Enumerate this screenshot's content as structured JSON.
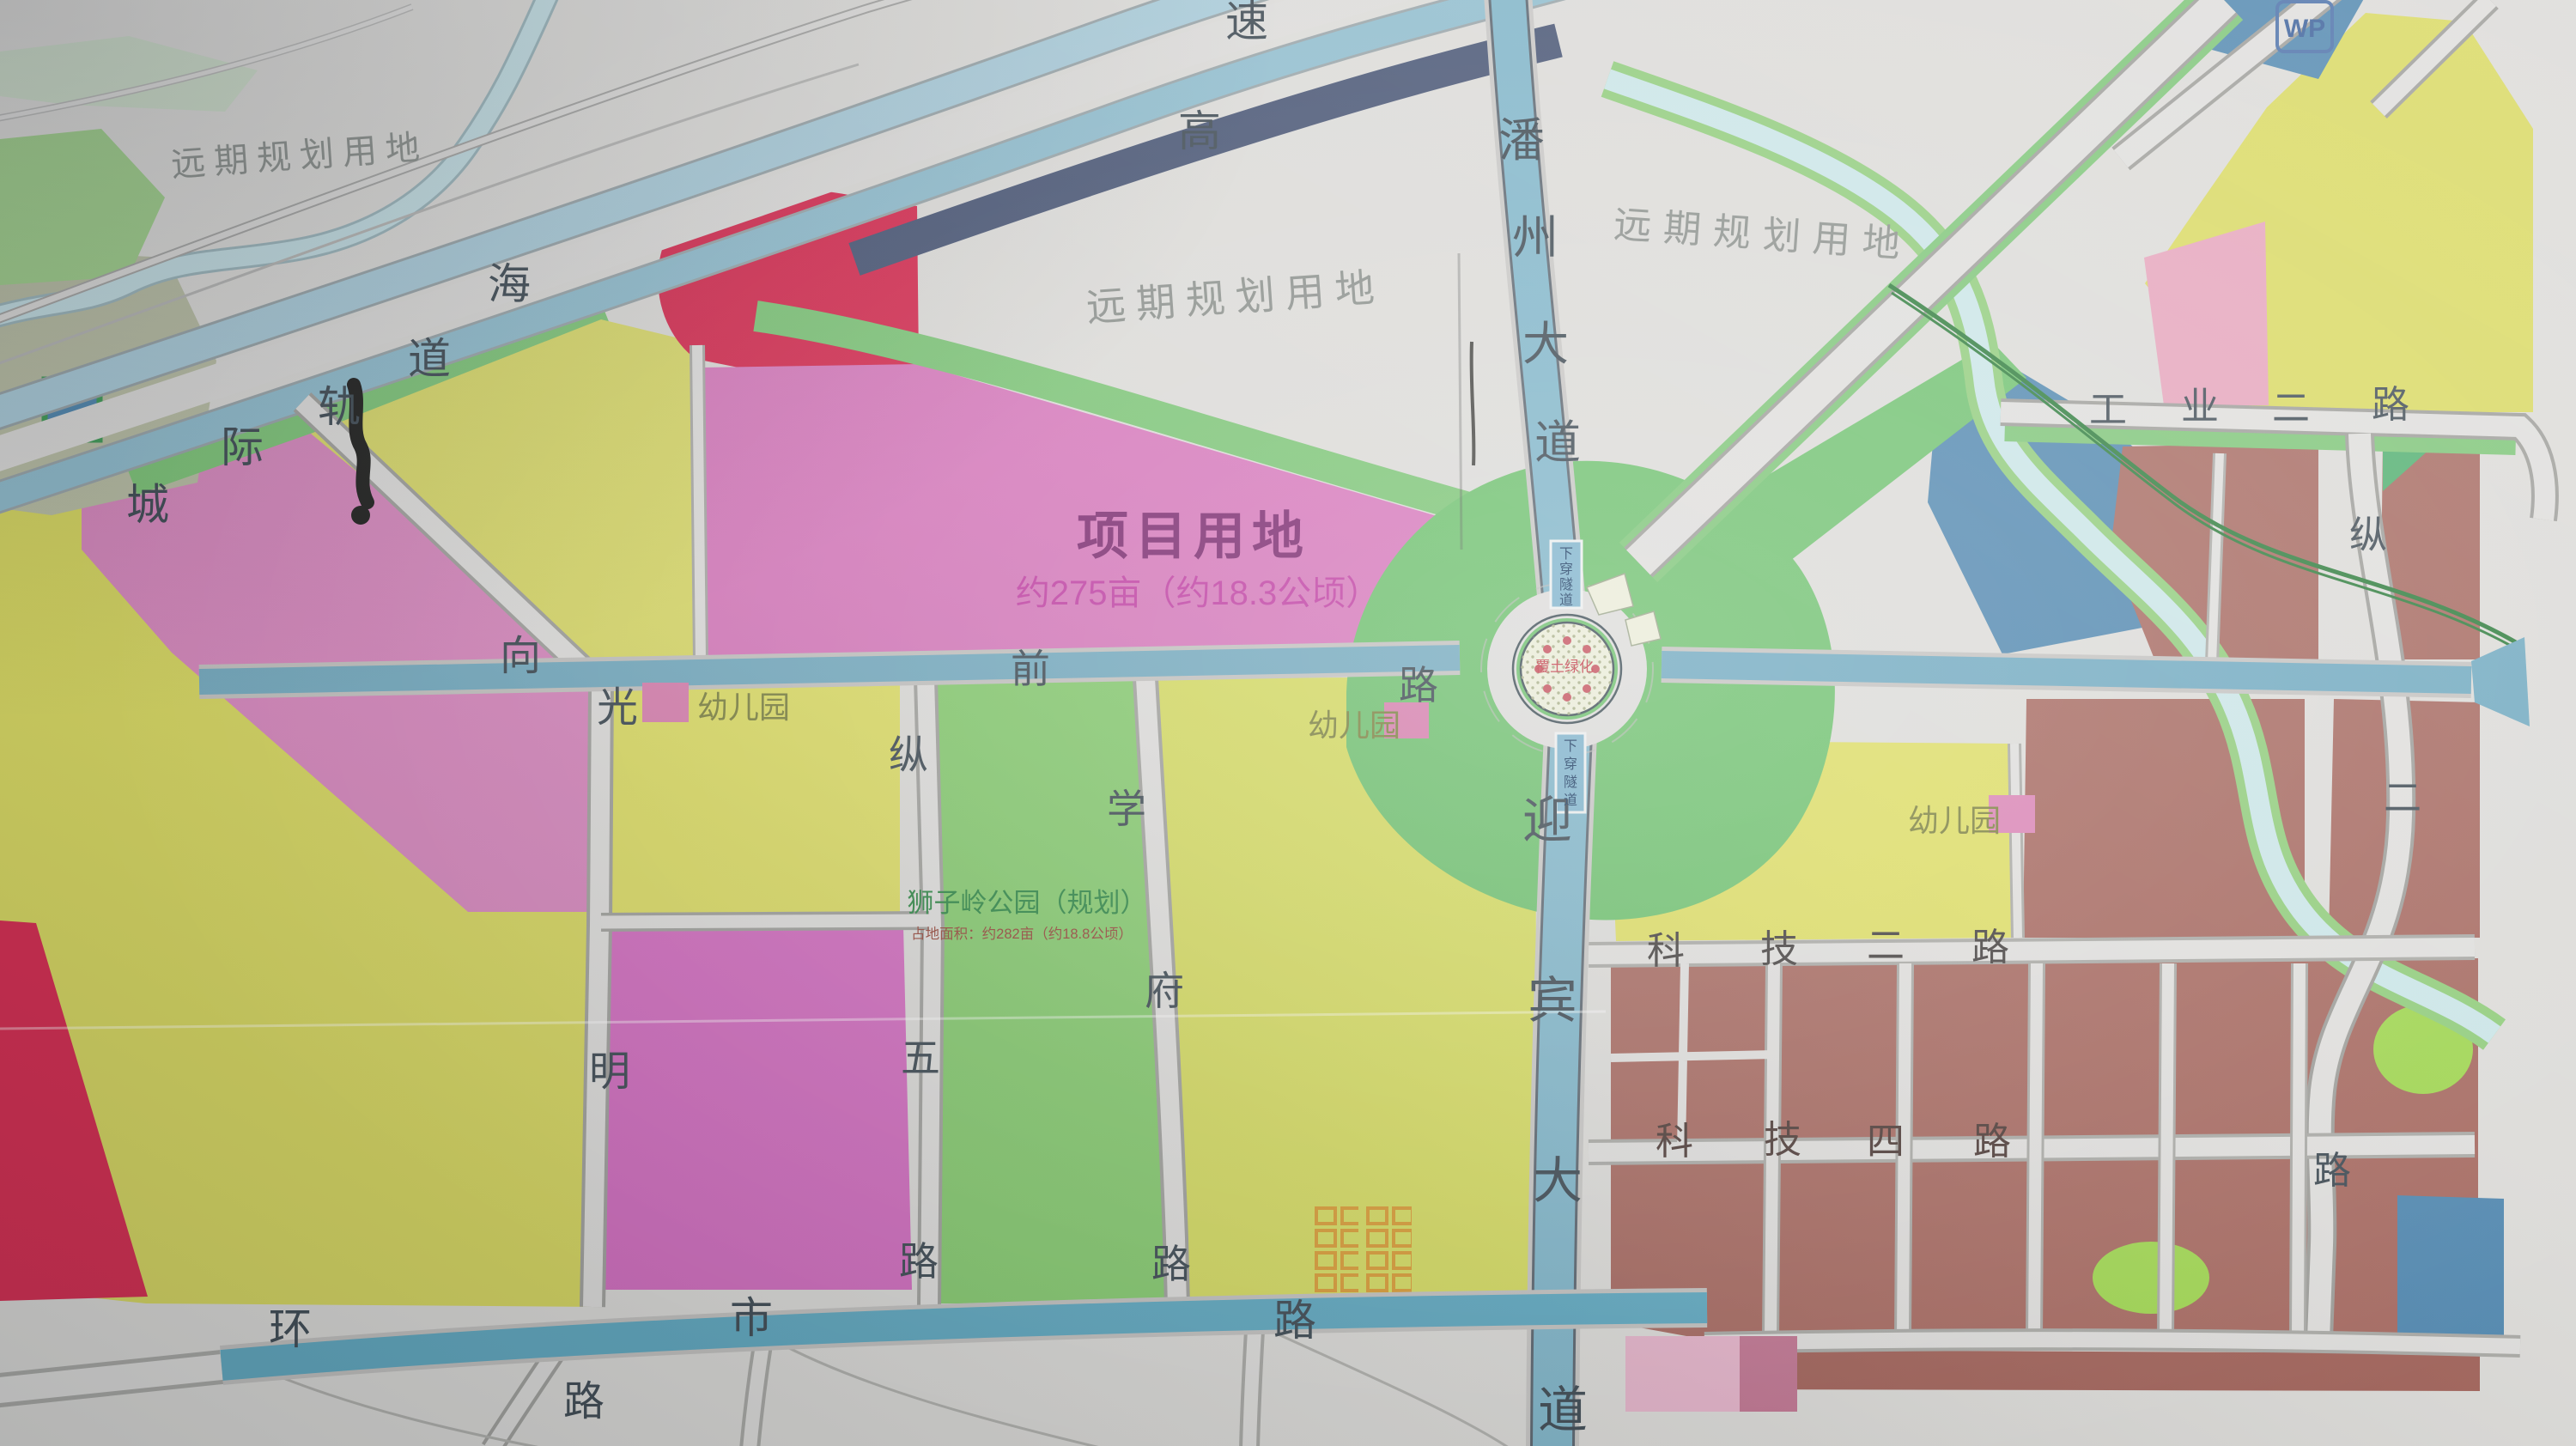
{
  "regions": {
    "future_planning_tl": "远期规划用地",
    "future_planning_center": "远期规划用地",
    "future_planning_right": "远期规划用地",
    "project_site": {
      "title": "项目用地",
      "area": "约275亩（约18.3公顷）"
    },
    "lion_ridge_park": {
      "title": "狮子岭公园（规划）",
      "area": "占地面积：约282亩（约18.8公顷）"
    },
    "kindergarten": "幼儿园"
  },
  "roundabout": {
    "center_label": "覆土绿化",
    "tunnel_label": "下穿隧道",
    "tunnel_chars": [
      "下",
      "穿",
      "隧",
      "道"
    ]
  },
  "roads": {
    "panzhou_avenue": {
      "name": "潘州大道",
      "chars": [
        "潘",
        "州",
        "大",
        "道"
      ]
    },
    "yingbin_avenue": {
      "name": "迎宾大道",
      "chars": [
        "迎",
        "宾",
        "大",
        "道"
      ]
    },
    "intercity_rail": {
      "name": "城际轨道",
      "chars": [
        "城",
        "际",
        "轨",
        "道"
      ]
    },
    "expressway": {
      "name": "高速",
      "chars": [
        "海",
        "高",
        "速"
      ]
    },
    "qianlu": {
      "name": "前路",
      "chars": [
        "前",
        "路"
      ]
    },
    "xiangguangming": {
      "name": "向光明路",
      "chars": [
        "向",
        "光",
        "明",
        "路"
      ]
    },
    "zongwu": {
      "name": "纵五路",
      "chars": [
        "纵",
        "五",
        "路"
      ]
    },
    "xuefu": {
      "name": "学府路",
      "chars": [
        "学",
        "府",
        "路"
      ]
    },
    "huanshi": {
      "name": "环市路",
      "chars": [
        "环",
        "市",
        "路"
      ]
    },
    "keji_er": {
      "name": "科技二路",
      "chars": [
        "科",
        "技",
        "二",
        "路"
      ]
    },
    "keji_si": {
      "name": "科技四路",
      "chars": [
        "科",
        "技",
        "四",
        "路"
      ]
    },
    "gongye_er": {
      "name": "工业二路",
      "chars": [
        "工",
        "业",
        "二",
        "路"
      ]
    },
    "zong_er": {
      "name": "纵二路",
      "chars": [
        "纵",
        "二",
        "路"
      ]
    }
  },
  "markers": {
    "wp_badge": "WP"
  },
  "palette": {
    "paper": "#dbdad7",
    "road_blue": "#74aabf",
    "road_blue_bright": "#5fa8c0",
    "expressway_navy": "#475473",
    "parcel_yellow": "#d7d75f",
    "parcel_green": "#6ec06e",
    "parcel_magenta": "#d26cbf",
    "parcel_pink": "#d787bd",
    "parcel_red": "#d5294e",
    "parcel_brown": "#a5685f",
    "parcel_blue": "#4f86ae",
    "river": "#c9e4e6",
    "kindergarten_pink": "#d77fae"
  }
}
